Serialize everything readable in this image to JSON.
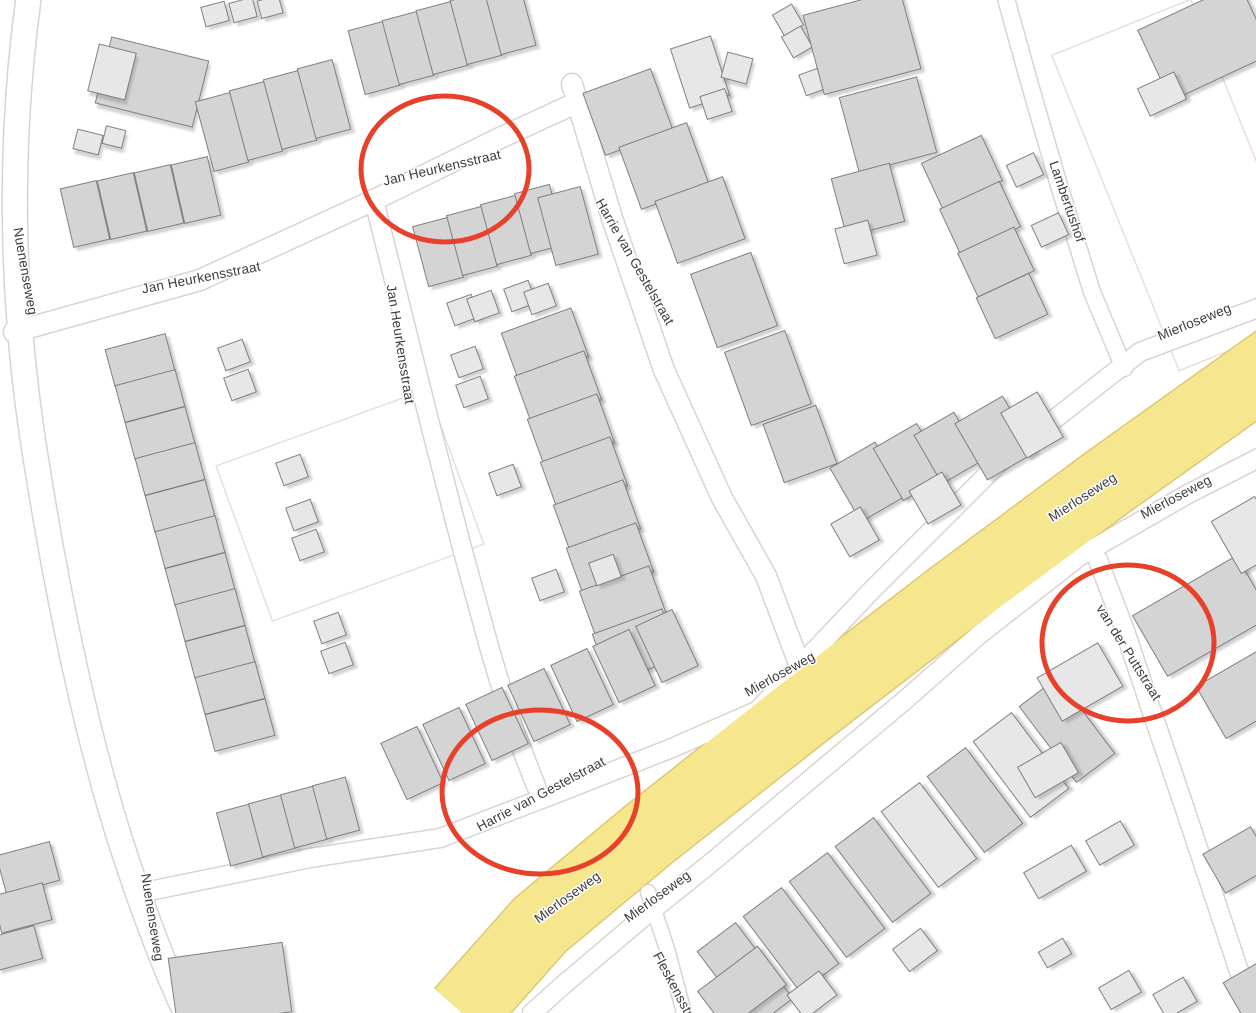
{
  "map": {
    "colors": {
      "background": "#ffffff",
      "road_fill": "#ffffff",
      "road_casing": "#d9d4cf",
      "highway_fill": "#f6e78f",
      "highway_casing": "#ddc873",
      "building_dark": "#d4d4d4",
      "building_light": "#e7e7e7",
      "building_stroke": "#757575",
      "courtyard_stroke": "#eadfd8",
      "label_color": "#3b3b3b",
      "annotation_color": "#e7412b"
    },
    "labels": [
      {
        "text": "Jan Heurkensstraat",
        "x": 443,
        "y": 172,
        "rot": -13
      },
      {
        "text": "Jan Heurkensstraat",
        "x": 202,
        "y": 282,
        "rot": -11
      },
      {
        "text": "Nuenenseweg",
        "x": 21,
        "y": 272,
        "rot": 80
      },
      {
        "text": "Jan Heurkensstraat",
        "x": 396,
        "y": 345,
        "rot": 81
      },
      {
        "text": "Harrie van Gestelstraat",
        "x": 631,
        "y": 264,
        "rot": 60
      },
      {
        "text": "Lambertushof",
        "x": 1063,
        "y": 203,
        "rot": 71
      },
      {
        "text": "Mierloseweg",
        "x": 1196,
        "y": 326,
        "rot": -22
      },
      {
        "text": "Mierloseweg",
        "x": 1085,
        "y": 501,
        "rot": -33
      },
      {
        "text": "Mierloseweg",
        "x": 1178,
        "y": 501,
        "rot": -28
      },
      {
        "text": "van der Puttstraat",
        "x": 1125,
        "y": 655,
        "rot": 58
      },
      {
        "text": "Mierloseweg",
        "x": 782,
        "y": 678,
        "rot": -29
      },
      {
        "text": "Harrie van Gestelstraat",
        "x": 543,
        "y": 798,
        "rot": -28
      },
      {
        "text": "Mierloseweg",
        "x": 570,
        "y": 901,
        "rot": -36
      },
      {
        "text": "Mierloseweg",
        "x": 660,
        "y": 900,
        "rot": -36
      },
      {
        "text": "Nuenenseweg",
        "x": 148,
        "y": 918,
        "rot": 81
      },
      {
        "text": "Fleskensstraat",
        "x": 674,
        "y": 995,
        "rot": 62
      }
    ],
    "roads": [
      {
        "name": "nuenenseweg",
        "width": 24,
        "path": "M 30,-12 C 8,140 10,300 36,460 C 60,610 90,750 126,858 C 150,930 168,975 186,1013"
      },
      {
        "name": "jan-heurkensstraat-west",
        "width": 20,
        "path": "M 14,332 L 200,280 L 370,202 L 500,138 L 578,102"
      },
      {
        "name": "jan-heurkensstraat-south",
        "width": 18,
        "path": "M 374,200 L 398,296 L 430,424 L 462,548 L 490,650 L 512,724 L 536,786"
      },
      {
        "name": "harrie-van-gestelstraat-north",
        "width": 20,
        "path": "M 572,84 L 612,218 L 664,370 L 722,498 L 766,576 L 800,666"
      },
      {
        "name": "harrie-van-gestelstraat-south",
        "width": 18,
        "path": "M 140,893 L 310,858 L 440,838 L 560,792 L 672,748 L 800,692"
      },
      {
        "name": "mierloseweg-northwest-lane",
        "width": 18,
        "path": "M 1290,296 L 1140,352 L 1000,462 L 872,590 L 796,670 L 714,756 L 645,826"
      },
      {
        "name": "mierloseweg-southeast-lane",
        "width": 18,
        "path": "M 1290,442 L 1188,494 L 1080,556 L 980,634 L 905,700 L 800,788 L 712,862 L 640,920 L 562,986 L 532,1013"
      },
      {
        "name": "van-der-puttstraat",
        "width": 18,
        "path": "M 1098,560 L 1124,628 L 1152,712 L 1186,812 L 1218,908 L 1244,986 L 1254,1013"
      },
      {
        "name": "lambertushof",
        "width": 16,
        "path": "M 1005,-5 L 1028,78 L 1058,182 L 1092,292 L 1124,368"
      },
      {
        "name": "fleskensstraat",
        "width": 14,
        "path": "M 648,892 L 668,952 L 684,1013"
      }
    ],
    "highway": {
      "name": "mierloseweg-main",
      "width": 72,
      "path": "M 1290,352 L 1108,482 L 952,598 L 800,715 L 648,835 L 540,925 L 462,1013"
    },
    "courtyards": [
      {
        "x": 350,
        "y": 505,
        "w": 225,
        "h": 165,
        "rot": -20
      },
      {
        "x": 1185,
        "y": 185,
        "w": 150,
        "h": 340,
        "rot": -22
      }
    ],
    "annotations": [
      {
        "cx": 445,
        "cy": 169,
        "rx": 84,
        "ry": 73
      },
      {
        "cx": 540,
        "cy": 792,
        "rx": 98,
        "ry": 82
      },
      {
        "cx": 1128,
        "cy": 643,
        "rx": 86,
        "ry": 78
      }
    ],
    "buildings": [
      [
        152,
        82,
        100,
        68,
        14,
        "d"
      ],
      [
        112,
        72,
        38,
        48,
        14,
        "l"
      ],
      [
        88,
        142,
        26,
        20,
        14,
        "l"
      ],
      [
        114,
        137,
        20,
        18,
        14,
        "l"
      ],
      [
        85,
        214,
        37,
        60,
        -13,
        "d"
      ],
      [
        122,
        206,
        37,
        60,
        -13,
        "d"
      ],
      [
        159,
        198,
        37,
        60,
        -13,
        "d"
      ],
      [
        196,
        190,
        37,
        60,
        -13,
        "d"
      ],
      [
        215,
        14,
        24,
        20,
        -15,
        "l"
      ],
      [
        243,
        10,
        24,
        20,
        -15,
        "l"
      ],
      [
        270,
        7,
        22,
        18,
        -15,
        "l"
      ],
      [
        222,
        132,
        36,
        72,
        -15,
        "d"
      ],
      [
        256,
        121,
        36,
        72,
        -15,
        "d"
      ],
      [
        290,
        110,
        36,
        72,
        -15,
        "d"
      ],
      [
        324,
        99,
        36,
        72,
        -15,
        "d"
      ],
      [
        374,
        58,
        36,
        66,
        -15,
        "d"
      ],
      [
        408,
        48,
        36,
        66,
        -15,
        "d"
      ],
      [
        442,
        38,
        36,
        66,
        -15,
        "d"
      ],
      [
        476,
        28,
        36,
        66,
        -15,
        "d"
      ],
      [
        510,
        18,
        36,
        66,
        -15,
        "d"
      ],
      [
        438,
        252,
        36,
        62,
        -15,
        "d"
      ],
      [
        472,
        241,
        36,
        62,
        -15,
        "d"
      ],
      [
        506,
        230,
        36,
        62,
        -15,
        "d"
      ],
      [
        540,
        219,
        36,
        62,
        -15,
        "d"
      ],
      [
        568,
        226,
        44,
        70,
        -15,
        "d"
      ],
      [
        700,
        72,
        42,
        62,
        -18,
        "l"
      ],
      [
        716,
        104,
        26,
        24,
        -18,
        "l"
      ],
      [
        737,
        68,
        26,
        26,
        15,
        "l"
      ],
      [
        788,
        20,
        22,
        24,
        -30,
        "l"
      ],
      [
        797,
        42,
        22,
        24,
        -30,
        "l"
      ],
      [
        812,
        82,
        20,
        22,
        -20,
        "l"
      ],
      [
        628,
        112,
        72,
        66,
        -20,
        "d"
      ],
      [
        664,
        166,
        72,
        66,
        -20,
        "d"
      ],
      [
        700,
        220,
        72,
        66,
        -20,
        "d"
      ],
      [
        862,
        42,
        100,
        82,
        -15,
        "d"
      ],
      [
        888,
        125,
        80,
        78,
        -15,
        "d"
      ],
      [
        868,
        200,
        60,
        60,
        -15,
        "d"
      ],
      [
        856,
        242,
        34,
        36,
        -15,
        "l"
      ],
      [
        734,
        300,
        64,
        78,
        -20,
        "d"
      ],
      [
        768,
        378,
        64,
        78,
        -20,
        "d"
      ],
      [
        800,
        444,
        56,
        62,
        -20,
        "d"
      ],
      [
        868,
        482,
        52,
        62,
        -30,
        "d"
      ],
      [
        910,
        462,
        50,
        60,
        -30,
        "d"
      ],
      [
        948,
        448,
        46,
        56,
        -30,
        "d"
      ],
      [
        935,
        498,
        38,
        38,
        -30,
        "l"
      ],
      [
        855,
        532,
        34,
        38,
        -30,
        "l"
      ],
      [
        995,
        438,
        55,
        65,
        -30,
        "d"
      ],
      [
        1032,
        425,
        42,
        52,
        -30,
        "l"
      ],
      [
        962,
        172,
        66,
        50,
        -25,
        "d"
      ],
      [
        980,
        218,
        66,
        50,
        -25,
        "d"
      ],
      [
        996,
        262,
        62,
        48,
        -25,
        "d"
      ],
      [
        1012,
        306,
        58,
        45,
        -25,
        "d"
      ],
      [
        1205,
        42,
        112,
        78,
        -25,
        "d"
      ],
      [
        1162,
        94,
        40,
        30,
        -25,
        "l"
      ],
      [
        1025,
        170,
        30,
        24,
        -25,
        "l"
      ],
      [
        1050,
        230,
        30,
        24,
        -25,
        "l"
      ],
      [
        545,
        345,
        74,
        52,
        -20,
        "d"
      ],
      [
        558,
        388,
        74,
        52,
        -20,
        "d"
      ],
      [
        571,
        431,
        74,
        52,
        -20,
        "d"
      ],
      [
        584,
        474,
        74,
        52,
        -20,
        "d"
      ],
      [
        597,
        517,
        74,
        52,
        -20,
        "d"
      ],
      [
        610,
        560,
        74,
        52,
        -20,
        "d"
      ],
      [
        623,
        603,
        74,
        52,
        -20,
        "d"
      ],
      [
        636,
        646,
        74,
        52,
        -20,
        "d"
      ],
      [
        412,
        763,
        40,
        62,
        -25,
        "d"
      ],
      [
        454,
        744,
        40,
        62,
        -25,
        "d"
      ],
      [
        497,
        724,
        40,
        62,
        -25,
        "d"
      ],
      [
        539,
        705,
        40,
        62,
        -25,
        "d"
      ],
      [
        582,
        685,
        40,
        62,
        -25,
        "d"
      ],
      [
        624,
        666,
        40,
        62,
        -25,
        "d"
      ],
      [
        667,
        646,
        40,
        62,
        -25,
        "d"
      ],
      [
        140,
        360,
        62,
        38,
        -15,
        "d"
      ],
      [
        150,
        396,
        62,
        38,
        -15,
        "d"
      ],
      [
        160,
        433,
        62,
        38,
        -15,
        "d"
      ],
      [
        170,
        469,
        62,
        38,
        -15,
        "d"
      ],
      [
        180,
        506,
        62,
        38,
        -15,
        "d"
      ],
      [
        190,
        542,
        62,
        38,
        -15,
        "d"
      ],
      [
        200,
        579,
        62,
        38,
        -15,
        "d"
      ],
      [
        210,
        615,
        62,
        38,
        -15,
        "d"
      ],
      [
        220,
        652,
        62,
        38,
        -15,
        "d"
      ],
      [
        230,
        688,
        62,
        38,
        -15,
        "d"
      ],
      [
        240,
        725,
        62,
        38,
        -15,
        "d"
      ],
      [
        240,
        835,
        34,
        55,
        -15,
        "d"
      ],
      [
        272,
        826,
        34,
        55,
        -15,
        "d"
      ],
      [
        304,
        817,
        34,
        55,
        -15,
        "d"
      ],
      [
        336,
        808,
        34,
        55,
        -15,
        "d"
      ],
      [
        234,
        355,
        26,
        24,
        -20,
        "l"
      ],
      [
        240,
        385,
        26,
        24,
        -20,
        "l"
      ],
      [
        292,
        470,
        26,
        24,
        -20,
        "l"
      ],
      [
        302,
        515,
        26,
        24,
        -20,
        "l"
      ],
      [
        308,
        545,
        26,
        24,
        -20,
        "l"
      ],
      [
        330,
        628,
        26,
        24,
        -20,
        "l"
      ],
      [
        337,
        658,
        26,
        24,
        -20,
        "l"
      ],
      [
        463,
        310,
        26,
        24,
        -20,
        "l"
      ],
      [
        483,
        306,
        26,
        24,
        -20,
        "l"
      ],
      [
        520,
        296,
        26,
        24,
        -20,
        "l"
      ],
      [
        540,
        299,
        26,
        24,
        -20,
        "l"
      ],
      [
        467,
        362,
        26,
        24,
        -20,
        "l"
      ],
      [
        472,
        392,
        26,
        24,
        -20,
        "l"
      ],
      [
        505,
        480,
        26,
        24,
        -20,
        "l"
      ],
      [
        548,
        585,
        26,
        24,
        -20,
        "l"
      ],
      [
        605,
        570,
        26,
        24,
        -20,
        "l"
      ],
      [
        745,
        975,
        48,
        95,
        -37,
        "d"
      ],
      [
        791,
        940,
        48,
        95,
        -37,
        "d"
      ],
      [
        837,
        905,
        48,
        95,
        -37,
        "d"
      ],
      [
        883,
        870,
        48,
        95,
        -37,
        "d"
      ],
      [
        929,
        835,
        48,
        95,
        -37,
        "l"
      ],
      [
        975,
        800,
        48,
        95,
        -37,
        "d"
      ],
      [
        1021,
        765,
        48,
        95,
        -37,
        "l"
      ],
      [
        1067,
        730,
        48,
        95,
        -37,
        "d"
      ],
      [
        742,
        988,
        75,
        48,
        -37,
        "d"
      ],
      [
        915,
        950,
        35,
        28,
        -37,
        "l"
      ],
      [
        812,
        995,
        40,
        30,
        -37,
        "l"
      ],
      [
        1080,
        682,
        70,
        50,
        -30,
        "l"
      ],
      [
        1202,
        616,
        120,
        70,
        -30,
        "d"
      ],
      [
        1250,
        690,
        90,
        60,
        -30,
        "d"
      ],
      [
        1248,
        535,
        50,
        60,
        -30,
        "l"
      ],
      [
        1110,
        843,
        40,
        28,
        -30,
        "l"
      ],
      [
        1238,
        860,
        55,
        45,
        -30,
        "d"
      ],
      [
        1055,
        953,
        28,
        18,
        -30,
        "l"
      ],
      [
        1262,
        995,
        55,
        60,
        -30,
        "d"
      ],
      [
        1175,
        998,
        35,
        28,
        -30,
        "l"
      ],
      [
        1120,
        990,
        35,
        25,
        -30,
        "l"
      ],
      [
        1048,
        770,
        50,
        35,
        -30,
        "l"
      ],
      [
        1055,
        872,
        55,
        30,
        -30,
        "l"
      ],
      [
        230,
        985,
        115,
        70,
        -8,
        "d"
      ],
      [
        28,
        868,
        55,
        40,
        -15,
        "d"
      ],
      [
        22,
        908,
        52,
        38,
        -15,
        "d"
      ],
      [
        16,
        948,
        46,
        34,
        -15,
        "d"
      ]
    ]
  }
}
